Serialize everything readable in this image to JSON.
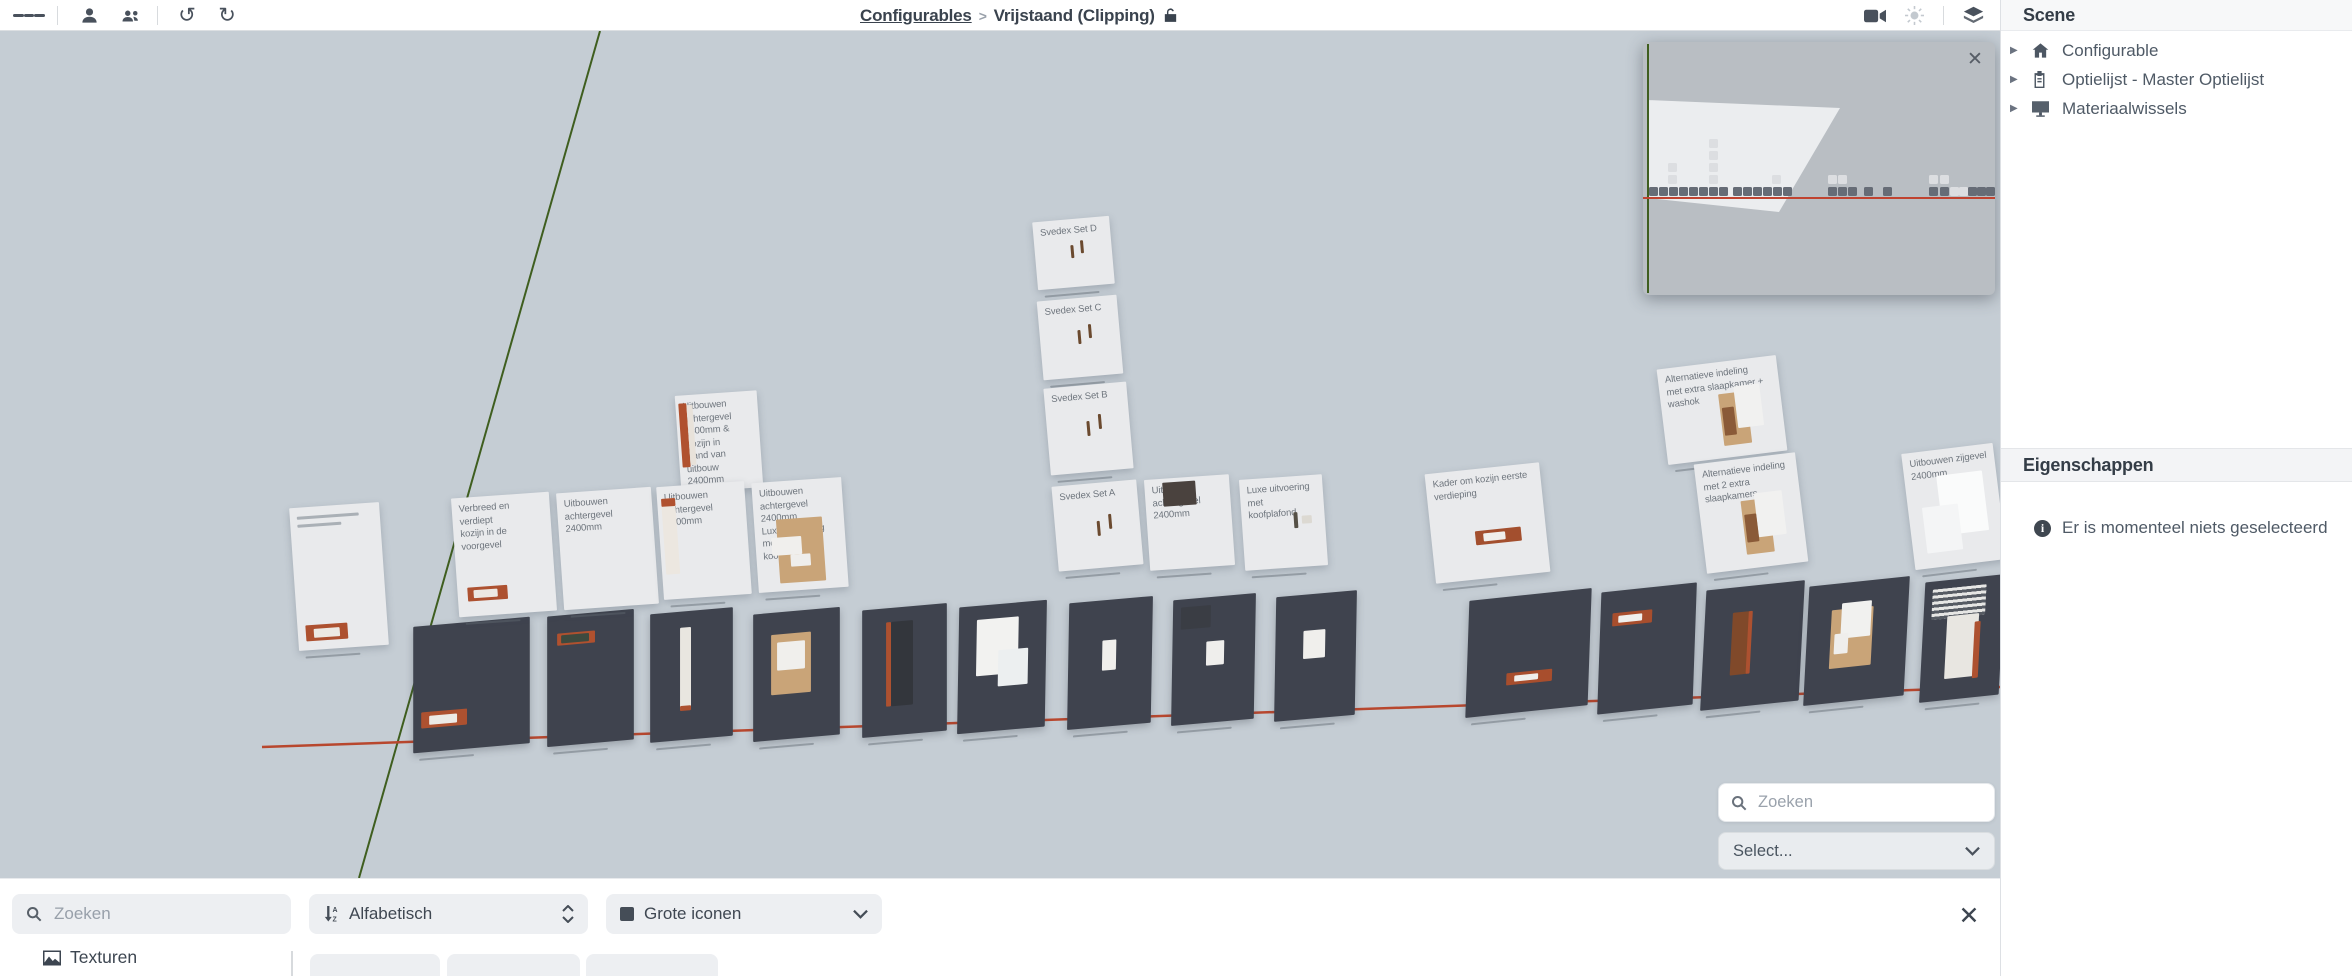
{
  "topbar": {
    "breadcrumb": {
      "root": "Configurables",
      "separator": ">",
      "current": "Vrijstaand (Clipping)"
    }
  },
  "sidebar": {
    "scene_title": "Scene",
    "tree": [
      {
        "label": "Configurable",
        "icon": "home-icon"
      },
      {
        "label": "Optielijst - Master Optielijst",
        "icon": "clipboard-icon"
      },
      {
        "label": "Materiaalwissels",
        "icon": "display-icon"
      }
    ],
    "properties_title": "Eigenschappen",
    "empty_message": "Er is momenteel niets geselecteerd"
  },
  "viewport": {
    "search_placeholder": "Zoeken",
    "select_label": "Select..."
  },
  "bottombar": {
    "search_placeholder": "Zoeken",
    "sort_label": "Alfabetisch",
    "icon_size_label": "Grote iconen",
    "tab_textures": "Texturen"
  },
  "colors": {
    "viewport_bg": "#c5cdd4",
    "tile": "#3f434e",
    "card": "#e9eaec",
    "accent_orange": "#ad5130",
    "axis_red": "#b8472e",
    "axis_green": "#3f5e1f",
    "minimap_bg": "#b9bec3"
  },
  "scene": {
    "lines": [
      {
        "x1": 600,
        "y1": 0,
        "x2": 359,
        "y2": 847,
        "c": "#3f5e1f",
        "w": 2
      },
      {
        "x1": 262,
        "y1": 716,
        "x2": 2000,
        "y2": 656,
        "c": "#b8472e",
        "w": 2.5
      }
    ],
    "minimap": {
      "x": 1643,
      "y": 11,
      "w": 352,
      "h": 253,
      "green_x": 4,
      "red_y": 155,
      "frustum": [
        [
          4,
          58
        ],
        [
          197,
          66
        ],
        [
          136,
          170
        ],
        [
          4,
          156
        ]
      ],
      "darks": [
        [
          6,
          145
        ],
        [
          16,
          145
        ],
        [
          26,
          145
        ],
        [
          36,
          145
        ],
        [
          46,
          145
        ],
        [
          56,
          145
        ],
        [
          66,
          145
        ],
        [
          76,
          145
        ],
        [
          90,
          145
        ],
        [
          100,
          145
        ],
        [
          110,
          145
        ],
        [
          120,
          145
        ],
        [
          130,
          145
        ],
        [
          140,
          145
        ],
        [
          185,
          145
        ],
        [
          195,
          145
        ],
        [
          205,
          145
        ],
        [
          221,
          145
        ],
        [
          240,
          145
        ],
        [
          286,
          145
        ],
        [
          297,
          145
        ],
        [
          325,
          145
        ],
        [
          334,
          145
        ],
        [
          343,
          145
        ]
      ],
      "lights": [
        [
          307,
          145
        ],
        [
          316,
          145
        ],
        [
          25,
          133
        ],
        [
          66,
          133
        ],
        [
          129,
          133
        ],
        [
          185,
          133
        ],
        [
          195,
          133
        ],
        [
          286,
          133
        ],
        [
          297,
          133
        ],
        [
          25,
          121
        ],
        [
          66,
          121
        ],
        [
          66,
          109
        ],
        [
          66,
          97
        ]
      ]
    },
    "cards": [
      {
        "x": 1035,
        "y": 188,
        "w": 77,
        "h": 68,
        "rot": -5,
        "label": "Svedex Set D",
        "cap": true,
        "objects": [
          {
            "x": 36,
            "y": 26,
            "w": 3,
            "h": 13,
            "c": "#6b4a2f"
          },
          {
            "x": 46,
            "y": 22,
            "w": 3,
            "h": 13,
            "c": "#6b4a2f"
          }
        ]
      },
      {
        "x": 1040,
        "y": 267,
        "w": 80,
        "h": 79,
        "rot": -5,
        "label": "Svedex Set C",
        "cap": true,
        "objects": [
          {
            "x": 38,
            "y": 32,
            "w": 3,
            "h": 14,
            "c": "#6b4a2f"
          },
          {
            "x": 49,
            "y": 27,
            "w": 3,
            "h": 14,
            "c": "#6b4a2f"
          }
        ]
      },
      {
        "x": 1047,
        "y": 354,
        "w": 83,
        "h": 87,
        "rot": -5,
        "label": "Svedex Set B",
        "cap": true,
        "objects": [
          {
            "x": 40,
            "y": 36,
            "w": 3,
            "h": 15,
            "c": "#6b4a2f"
          },
          {
            "x": 52,
            "y": 30,
            "w": 3,
            "h": 15,
            "c": "#6b4a2f"
          }
        ]
      },
      {
        "x": 1055,
        "y": 452,
        "w": 85,
        "h": 85,
        "rot": -5,
        "label": "Svedex Set A",
        "cap": true,
        "objects": [
          {
            "x": 42,
            "y": 38,
            "w": 3,
            "h": 15,
            "c": "#6b4a2f"
          },
          {
            "x": 54,
            "y": 32,
            "w": 3,
            "h": 15,
            "c": "#6b4a2f"
          }
        ]
      },
      {
        "x": 1147,
        "y": 446,
        "w": 85,
        "h": 91,
        "rot": -4,
        "label": "Uitbouwen achtergevel\n2400mm",
        "cap": true,
        "objects": [
          {
            "x": 18,
            "y": 4,
            "w": 33,
            "h": 24,
            "c": "#4a423e"
          }
        ]
      },
      {
        "x": 1242,
        "y": 446,
        "w": 83,
        "h": 91,
        "rot": -4,
        "label": "Luxe uitvoering met\nkoofplafond",
        "cap": true,
        "objects": [
          {
            "x": 52,
            "y": 36,
            "w": 4,
            "h": 16,
            "c": "#555046"
          },
          {
            "x": 60,
            "y": 40,
            "w": 10,
            "h": 8,
            "c": "#dcd9d2"
          }
        ]
      },
      {
        "x": 678,
        "y": 362,
        "w": 82,
        "h": 97,
        "rot": -4,
        "label": "Uitbouwen achtergevel\n2400mm & Kozijn in\nwand van uitbouw\n2400mm",
        "cap": true,
        "objects": [
          {
            "x": 3,
            "y": 8,
            "w": 8,
            "h": 64,
            "c": "#b0512f"
          },
          {
            "x": 11,
            "y": 10,
            "w": 6,
            "h": 60,
            "c": "#e8e2da"
          }
        ]
      },
      {
        "x": 294,
        "y": 474,
        "w": 90,
        "h": 143,
        "rot": -4,
        "cap": true,
        "objects": [
          {
            "x": 7,
            "y": 9,
            "w": 62,
            "h": 3,
            "c": "#aab0b6"
          },
          {
            "x": 7,
            "y": 17,
            "w": 44,
            "h": 3,
            "c": "#aab0b6"
          },
          {
            "x": 8,
            "y": 118,
            "w": 42,
            "h": 16,
            "c": "#ad5130"
          },
          {
            "x": 16,
            "y": 122,
            "w": 26,
            "h": 9,
            "c": "#ece9e3"
          }
        ]
      },
      {
        "x": 455,
        "y": 464,
        "w": 98,
        "h": 119,
        "rot": -4,
        "label": "Verbreed en verdiept\nkozijn in de voorgevel",
        "cap": true,
        "objects": [
          {
            "x": 10,
            "y": 90,
            "w": 40,
            "h": 14,
            "c": "#ad5130"
          },
          {
            "x": 16,
            "y": 93,
            "w": 24,
            "h": 8,
            "c": "#ece9e3"
          }
        ]
      },
      {
        "x": 560,
        "y": 459,
        "w": 95,
        "h": 117,
        "rot": -4,
        "label": "Uitbouwen achtergevel\n2400mm",
        "cap": true,
        "objects": []
      },
      {
        "x": 660,
        "y": 453,
        "w": 88,
        "h": 113,
        "rot": -4,
        "label": "Uitbouwen achtergevel\n2400mm",
        "cap": true,
        "objects": [
          {
            "x": 4,
            "y": 12,
            "w": 14,
            "h": 76,
            "c": "#ece7e0"
          },
          {
            "x": 4,
            "y": 12,
            "w": 14,
            "h": 8,
            "c": "#b0512f"
          }
        ]
      },
      {
        "x": 755,
        "y": 449,
        "w": 90,
        "h": 110,
        "rot": -4,
        "label": "Uitbouwen achtergevel\n2400mm\nLuxe uitvoering met\nkoofplafond",
        "cap": true,
        "objects": [
          {
            "x": 22,
            "y": 38,
            "w": 46,
            "h": 64,
            "c": "#c9a478"
          },
          {
            "x": 16,
            "y": 56,
            "w": 30,
            "h": 18,
            "c": "#f0efed"
          },
          {
            "x": 34,
            "y": 74,
            "w": 20,
            "h": 12,
            "c": "#efeeec"
          }
        ]
      },
      {
        "x": 1430,
        "y": 437,
        "w": 115,
        "h": 110,
        "rot": -6,
        "label": "Kader om kozijn eerste\nverdieping",
        "cap": true,
        "objects": [
          {
            "x": 44,
            "y": 62,
            "w": 46,
            "h": 14,
            "c": "#a34f2e"
          },
          {
            "x": 52,
            "y": 65,
            "w": 22,
            "h": 8,
            "c": "#f0efec"
          }
        ]
      },
      {
        "x": 1662,
        "y": 331,
        "w": 120,
        "h": 96,
        "rot": -7,
        "label": "Alternatieve indeling\nmet extra slaapkamer +\nwashok",
        "cap": true,
        "objects": [
          {
            "x": 58,
            "y": 32,
            "w": 28,
            "h": 52,
            "c": "#c9a478"
          },
          {
            "x": 74,
            "y": 26,
            "w": 26,
            "h": 42,
            "c": "#f1f1f0"
          },
          {
            "x": 60,
            "y": 46,
            "w": 12,
            "h": 28,
            "c": "#8a5a38"
          }
        ]
      },
      {
        "x": 1700,
        "y": 427,
        "w": 102,
        "h": 110,
        "rot": -7,
        "label": "Alternatieve indeling\nmet 2 extra\nslaapkamers",
        "cap": true,
        "objects": [
          {
            "x": 42,
            "y": 42,
            "w": 28,
            "h": 54,
            "c": "#c9a478"
          },
          {
            "x": 56,
            "y": 36,
            "w": 28,
            "h": 44,
            "c": "#f1f1f0"
          },
          {
            "x": 44,
            "y": 56,
            "w": 12,
            "h": 28,
            "c": "#8a5a38"
          }
        ]
      },
      {
        "x": 1908,
        "y": 417,
        "w": 92,
        "h": 117,
        "rot": -7,
        "label": "Uitbouwen zijgevel\n2400mm",
        "cap": true,
        "objects": [
          {
            "x": 32,
            "y": 26,
            "w": 46,
            "h": 60,
            "c": "#fafbfb"
          },
          {
            "x": 14,
            "y": 56,
            "w": 36,
            "h": 46,
            "c": "#f4f5f6"
          }
        ]
      }
    ],
    "tiles": [
      {
        "x": 413,
        "y": 591,
        "w": 117,
        "h": 126,
        "rot": -5,
        "skew": -5,
        "cap": true,
        "objects": [
          {
            "x": 8,
            "y": 86,
            "w": 46,
            "h": 16,
            "c": "#ad5130"
          },
          {
            "x": 16,
            "y": 90,
            "w": 28,
            "h": 9,
            "c": "#eceae6"
          }
        ]
      },
      {
        "x": 547,
        "y": 582,
        "w": 87,
        "h": 130,
        "rot": -5,
        "skew": -5,
        "cap": true,
        "objects": [
          {
            "x": 10,
            "y": 18,
            "w": 38,
            "h": 12,
            "c": "#b0512f"
          },
          {
            "x": 14,
            "y": 20,
            "w": 28,
            "h": 8,
            "c": "#3d4a3f"
          }
        ]
      },
      {
        "x": 650,
        "y": 580,
        "w": 83,
        "h": 128,
        "rot": -5,
        "skew": -5,
        "cap": true,
        "objects": [
          {
            "x": 30,
            "y": 16,
            "w": 11,
            "h": 82,
            "c": "#e9e6e0"
          },
          {
            "x": 30,
            "y": 94,
            "w": 11,
            "h": 5,
            "c": "#ad5130"
          }
        ]
      },
      {
        "x": 753,
        "y": 580,
        "w": 87,
        "h": 127,
        "rot": -5,
        "skew": -5,
        "cap": true,
        "objects": [
          {
            "x": 18,
            "y": 22,
            "w": 40,
            "h": 60,
            "c": "#c9a478"
          },
          {
            "x": 24,
            "y": 30,
            "w": 28,
            "h": 28,
            "c": "#f0efec"
          }
        ]
      },
      {
        "x": 862,
        "y": 576,
        "w": 85,
        "h": 127,
        "rot": -5,
        "skew": -5,
        "cap": true,
        "objects": [
          {
            "x": 24,
            "y": 14,
            "w": 5,
            "h": 84,
            "c": "#ad5130"
          },
          {
            "x": 29,
            "y": 14,
            "w": 22,
            "h": 84,
            "c": "#33363c"
          }
        ]
      },
      {
        "x": 958,
        "y": 573,
        "w": 88,
        "h": 126,
        "rot": -5,
        "skew": -6,
        "cap": true,
        "objects": [
          {
            "x": 18,
            "y": 14,
            "w": 42,
            "h": 56,
            "c": "#f2f2f0"
          },
          {
            "x": 40,
            "y": 46,
            "w": 30,
            "h": 36,
            "c": "#eceff0"
          }
        ]
      },
      {
        "x": 1068,
        "y": 569,
        "w": 84,
        "h": 126,
        "rot": -5,
        "skew": -6,
        "cap": true,
        "objects": [
          {
            "x": 34,
            "y": 40,
            "w": 14,
            "h": 30,
            "c": "#f0efec"
          }
        ]
      },
      {
        "x": 1172,
        "y": 566,
        "w": 83,
        "h": 125,
        "rot": -5,
        "skew": -6,
        "cap": true,
        "objects": [
          {
            "x": 8,
            "y": 8,
            "w": 30,
            "h": 22,
            "c": "#3a3d44"
          },
          {
            "x": 34,
            "y": 44,
            "w": 18,
            "h": 24,
            "c": "#efeeec"
          }
        ]
      },
      {
        "x": 1275,
        "y": 563,
        "w": 81,
        "h": 124,
        "rot": -5,
        "skew": -6,
        "cap": true,
        "objects": [
          {
            "x": 28,
            "y": 36,
            "w": 22,
            "h": 28,
            "c": "#f0efec"
          }
        ]
      },
      {
        "x": 1467,
        "y": 564,
        "w": 123,
        "h": 116,
        "rot": -6,
        "skew": -8,
        "cap": true,
        "objects": [
          {
            "x": 40,
            "y": 76,
            "w": 46,
            "h": 12,
            "c": "#a84e2d"
          },
          {
            "x": 48,
            "y": 79,
            "w": 24,
            "h": 6,
            "c": "#f0efec"
          }
        ]
      },
      {
        "x": 1599,
        "y": 557,
        "w": 96,
        "h": 121,
        "rot": -6,
        "skew": -8,
        "cap": true,
        "objects": [
          {
            "x": 12,
            "y": 22,
            "w": 40,
            "h": 13,
            "c": "#a84e2d"
          },
          {
            "x": 18,
            "y": 25,
            "w": 24,
            "h": 7,
            "c": "#f0efec"
          }
        ]
      },
      {
        "x": 1703,
        "y": 555,
        "w": 99,
        "h": 119,
        "rot": -6,
        "skew": -9,
        "cap": true,
        "objects": [
          {
            "x": 28,
            "y": 25,
            "w": 18,
            "h": 62,
            "c": "#80492a"
          },
          {
            "x": 44,
            "y": 25,
            "w": 4,
            "h": 62,
            "c": "#ad5130"
          }
        ]
      },
      {
        "x": 1806,
        "y": 551,
        "w": 101,
        "h": 118,
        "rot": -6,
        "skew": -9,
        "cap": true,
        "objects": [
          {
            "x": 24,
            "y": 26,
            "w": 42,
            "h": 58,
            "c": "#c9a478"
          },
          {
            "x": 34,
            "y": 20,
            "w": 30,
            "h": 35,
            "c": "#f1f1ef"
          },
          {
            "x": 28,
            "y": 50,
            "w": 14,
            "h": 20,
            "c": "#efeeec"
          }
        ]
      },
      {
        "x": 1922,
        "y": 548,
        "w": 80,
        "h": 119,
        "rot": -6,
        "skew": -9,
        "cap": true,
        "objects": [
          {
            "x": 8,
            "y": 8,
            "w": 54,
            "h": 30,
            "stripes": true
          },
          {
            "x": 24,
            "y": 36,
            "w": 32,
            "h": 62,
            "c": "#e8e6e1"
          },
          {
            "x": 52,
            "y": 44,
            "w": 6,
            "h": 56,
            "c": "#ad5130"
          }
        ]
      }
    ]
  }
}
